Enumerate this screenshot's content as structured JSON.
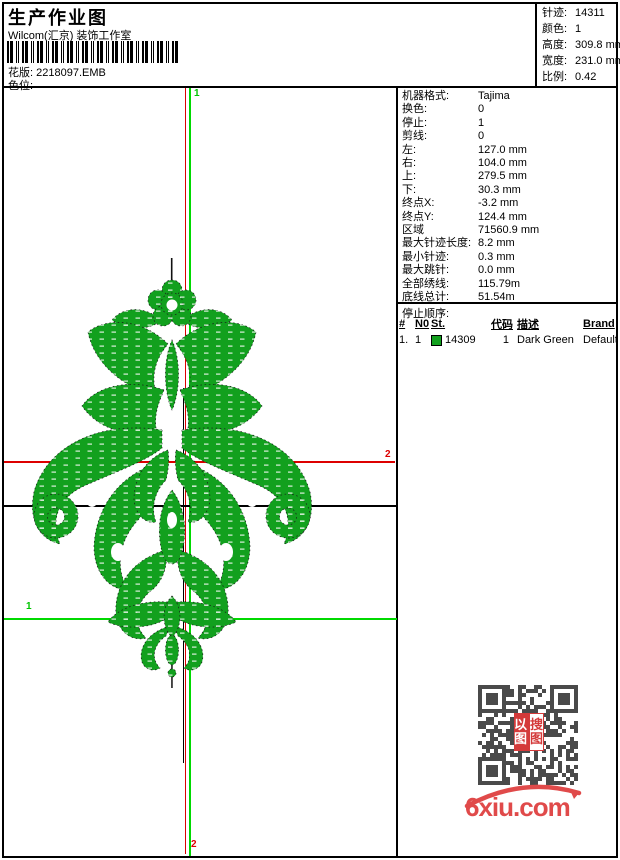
{
  "header": {
    "title": "生产作业图",
    "studio": "Wilcom(汇京) 装饰工作室",
    "pattern_label": "花版:",
    "pattern_value": "2218097.EMB",
    "color_slot_label": "色位:"
  },
  "summary": {
    "rows": [
      {
        "label": "针迹:",
        "value": "14311"
      },
      {
        "label": "颜色:",
        "value": "1"
      },
      {
        "label": "高度:",
        "value": "309.8 mm"
      },
      {
        "label": "宽度:",
        "value": "231.0 mm"
      },
      {
        "label": "比例:",
        "value": "0.42"
      }
    ]
  },
  "machine": {
    "rows": [
      {
        "label": "机器格式:",
        "value": "Tajima"
      },
      {
        "label": "换色:",
        "value": "0"
      },
      {
        "label": "停止:",
        "value": "1"
      },
      {
        "label": "剪线:",
        "value": "0"
      },
      {
        "label": "左:",
        "value": "127.0 mm"
      },
      {
        "label": "右:",
        "value": "104.0 mm"
      },
      {
        "label": "上:",
        "value": "279.5 mm"
      },
      {
        "label": "下:",
        "value": "30.3 mm"
      },
      {
        "label": "终点X:",
        "value": "-3.2 mm"
      },
      {
        "label": "终点Y:",
        "value": "124.4 mm"
      },
      {
        "label": "区域",
        "value": "71560.9 mm"
      },
      {
        "label": "最大针迹长度:",
        "value": "8.2 mm"
      },
      {
        "label": "最小针迹:",
        "value": "0.3 mm"
      },
      {
        "label": "最大跳针:",
        "value": "0.0 mm"
      },
      {
        "label": "全部绣线:",
        "value": "115.79m"
      },
      {
        "label": "底线总计:",
        "value": "51.54m"
      }
    ]
  },
  "stop_sequence_label": "停止顺序:",
  "thread_table": {
    "headers": [
      "#",
      "N0",
      "St.",
      "代码",
      "描述",
      "Brand",
      "元素"
    ],
    "row": {
      "index": "1.",
      "needle": "1",
      "swatch_color": "#12A01E",
      "stitches": "14309",
      "code": "1",
      "description": "Dark Green",
      "brand": "Default",
      "element": ""
    }
  },
  "markers": {
    "start_top": "1",
    "end_right": "2",
    "start_left": "1",
    "end_bottom": "2"
  },
  "watermark": {
    "site": "6xiu.com",
    "seal_left": "以图",
    "seal_right": "搜图"
  },
  "colors": {
    "design_green": "#12A01E",
    "crosshair_green": "#00D900",
    "crosshair_red": "#DD0000",
    "qr_dark": "#4A4A4A",
    "brand_red": "#E04A4A"
  }
}
